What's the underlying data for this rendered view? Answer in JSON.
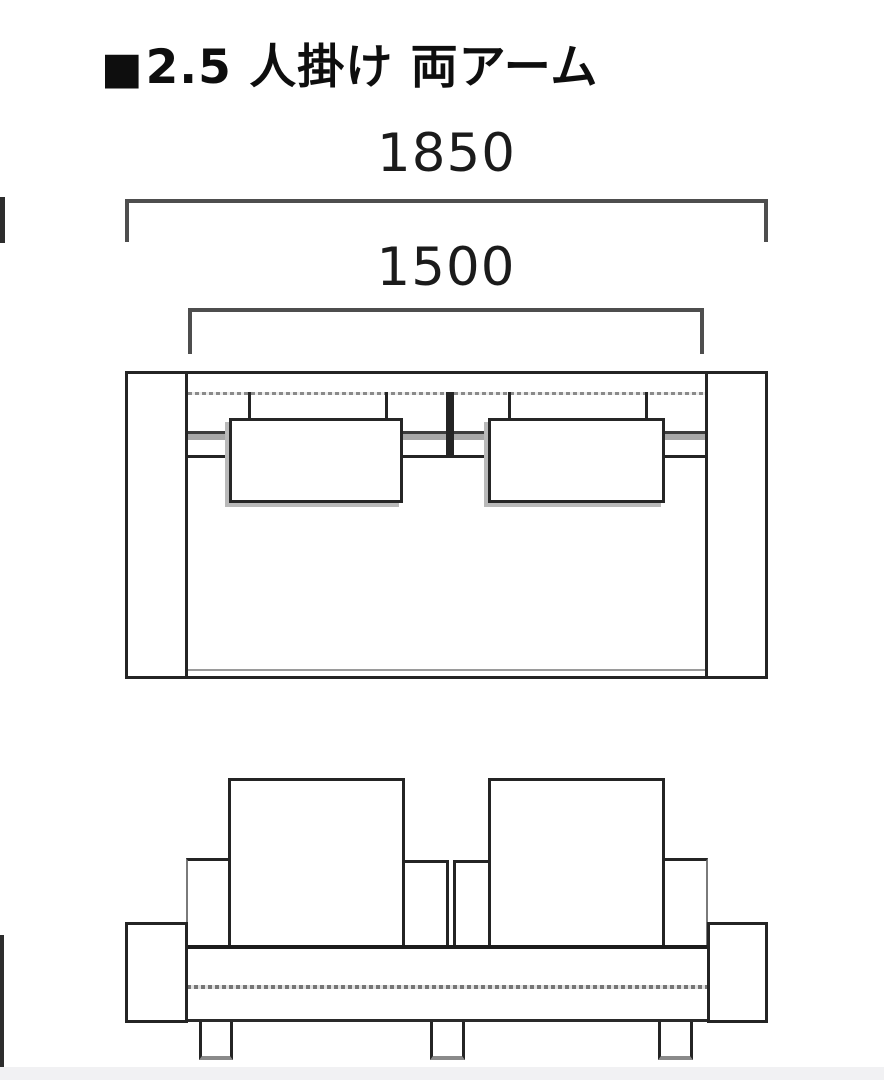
{
  "title": {
    "bullet": "■",
    "text": "2.5 人掛け 両アーム"
  },
  "dimensions": {
    "overall_width": "1850",
    "inner_width": "1500"
  },
  "diagram": {
    "type": "furniture-dimension-drawing",
    "views": [
      "top-plan-view",
      "front-view"
    ],
    "seat_cushions": 2,
    "legs_visible": 3
  },
  "colors": {
    "line_dark": "#242424",
    "line_gray": "#9a9a9a",
    "bracket_gray": "#4e4e4e",
    "cushion_shadow": "#b9b9b9",
    "background": "#ffffff",
    "bottom_strip": "#f1f1f3"
  }
}
